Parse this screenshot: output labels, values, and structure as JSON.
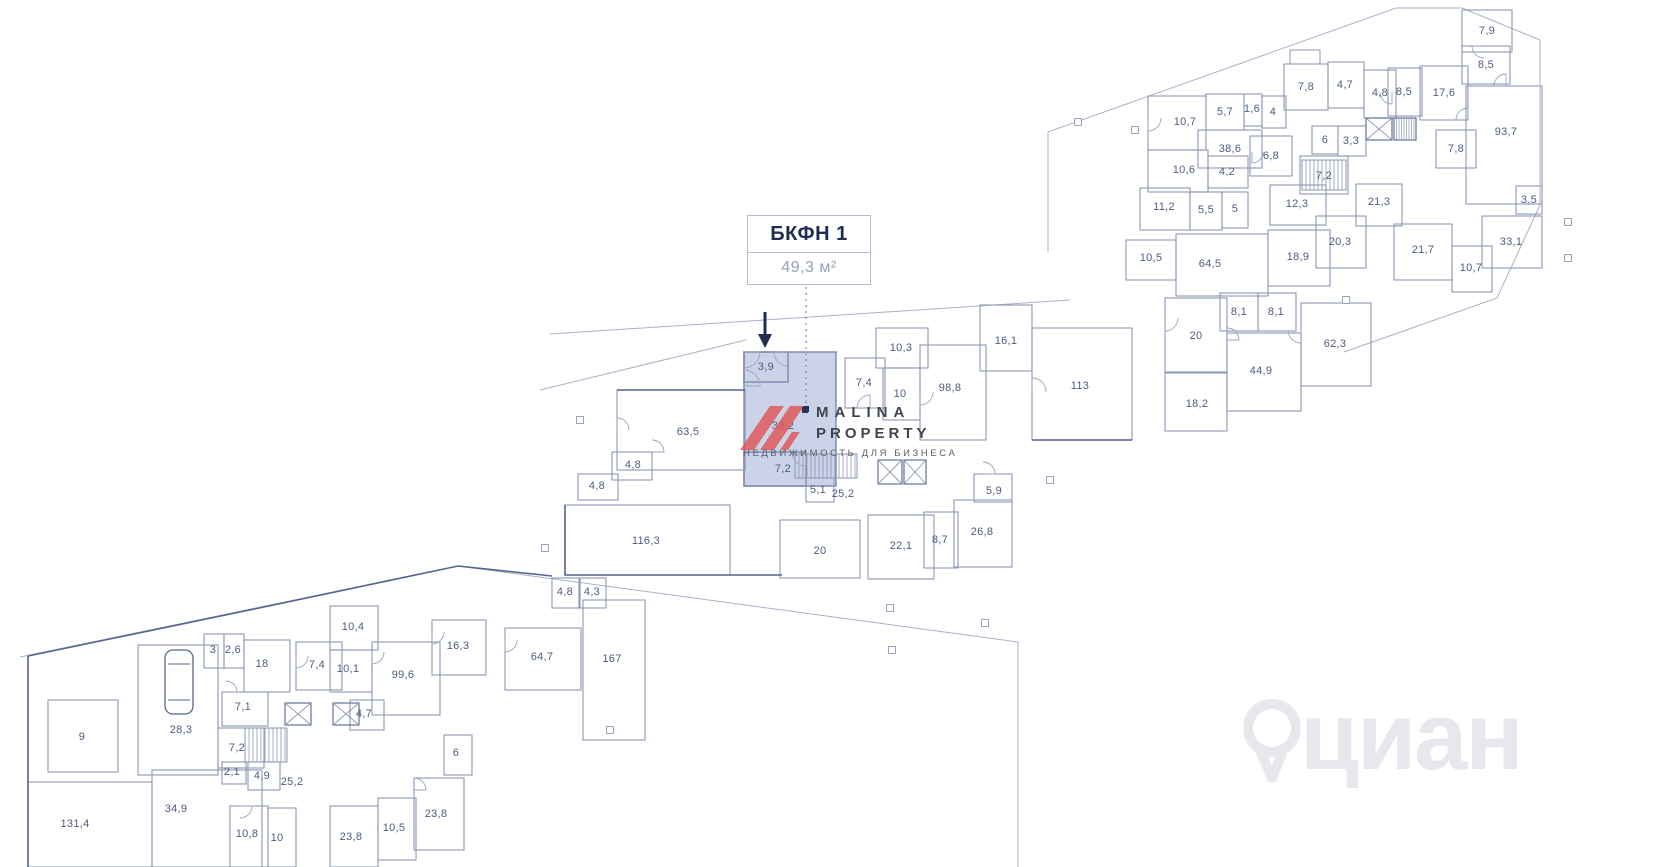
{
  "callout": {
    "title": "БКФН 1",
    "area": "49,3 м²"
  },
  "highlighted_unit": {
    "name": "БКФН 1",
    "total_area": "49,3 м²",
    "fill_color": "#cbd3e9",
    "room_areas": [
      "3,9",
      "38,2",
      "7,2"
    ]
  },
  "brand": {
    "line1": "MALINA",
    "line2": "PROPERTY",
    "tagline": "НЕДВИЖИМОСТЬ ДЛЯ БИЗНЕСА",
    "logo_color": "#e05b5b"
  },
  "cian": {
    "text": "циан"
  },
  "colors": {
    "wall": "#56648e",
    "wall_light": "#8d97b6",
    "site_line": "#a9b1c9",
    "label": "#4d5b80",
    "accent_navy": "#1f2d52",
    "highlight": "#cbd3e9",
    "logo_red": "#e05b5b"
  },
  "rooms": [
    {
      "label": "10,7",
      "x": 1185,
      "y": 122
    },
    {
      "label": "5,7",
      "x": 1225,
      "y": 112
    },
    {
      "label": "1,6",
      "x": 1252,
      "y": 109
    },
    {
      "label": "4",
      "x": 1273,
      "y": 112
    },
    {
      "label": "38,6",
      "x": 1230,
      "y": 149
    },
    {
      "label": "10,6",
      "x": 1184,
      "y": 170
    },
    {
      "label": "4,2",
      "x": 1227,
      "y": 172
    },
    {
      "label": "6,8",
      "x": 1271,
      "y": 156
    },
    {
      "label": "7,8",
      "x": 1306,
      "y": 87
    },
    {
      "label": "4,7",
      "x": 1345,
      "y": 85
    },
    {
      "label": "4,8",
      "x": 1380,
      "y": 93
    },
    {
      "label": "8,5",
      "x": 1404,
      "y": 92
    },
    {
      "label": "17,6",
      "x": 1444,
      "y": 93
    },
    {
      "label": "7,9",
      "x": 1487,
      "y": 31
    },
    {
      "label": "8,5",
      "x": 1486,
      "y": 65
    },
    {
      "label": "93,7",
      "x": 1506,
      "y": 132
    },
    {
      "label": "7,8",
      "x": 1456,
      "y": 149
    },
    {
      "label": "6",
      "x": 1325,
      "y": 140
    },
    {
      "label": "3,3",
      "x": 1351,
      "y": 141
    },
    {
      "label": "7,2",
      "x": 1324,
      "y": 176
    },
    {
      "label": "11,2",
      "x": 1164,
      "y": 207
    },
    {
      "label": "5,5",
      "x": 1206,
      "y": 210
    },
    {
      "label": "5",
      "x": 1235,
      "y": 209
    },
    {
      "label": "12,3",
      "x": 1297,
      "y": 204
    },
    {
      "label": "10,5",
      "x": 1151,
      "y": 258
    },
    {
      "label": "64,5",
      "x": 1210,
      "y": 264
    },
    {
      "label": "18,9",
      "x": 1298,
      "y": 257
    },
    {
      "label": "20,3",
      "x": 1340,
      "y": 242
    },
    {
      "label": "21,3",
      "x": 1379,
      "y": 202
    },
    {
      "label": "21,7",
      "x": 1423,
      "y": 250
    },
    {
      "label": "10,7",
      "x": 1471,
      "y": 268
    },
    {
      "label": "33,1",
      "x": 1511,
      "y": 242
    },
    {
      "label": "3,5",
      "x": 1529,
      "y": 200
    },
    {
      "label": "20",
      "x": 1196,
      "y": 336
    },
    {
      "label": "8,1",
      "x": 1239,
      "y": 312
    },
    {
      "label": "8,1",
      "x": 1276,
      "y": 312
    },
    {
      "label": "44,9",
      "x": 1261,
      "y": 371
    },
    {
      "label": "62,3",
      "x": 1335,
      "y": 344
    },
    {
      "label": "18,2",
      "x": 1197,
      "y": 404
    },
    {
      "label": "113",
      "x": 1080,
      "y": 386
    },
    {
      "label": "16,1",
      "x": 1006,
      "y": 341
    },
    {
      "label": "98,8",
      "x": 950,
      "y": 388
    },
    {
      "label": "10",
      "x": 900,
      "y": 394
    },
    {
      "label": "7,4",
      "x": 864,
      "y": 383
    },
    {
      "label": "10,3",
      "x": 901,
      "y": 348
    },
    {
      "label": "63,5",
      "x": 688,
      "y": 432
    },
    {
      "label": "3,9",
      "x": 766,
      "y": 367
    },
    {
      "label": "38,2",
      "x": 783,
      "y": 426
    },
    {
      "label": "7,2",
      "x": 783,
      "y": 469
    },
    {
      "label": "4,8",
      "x": 633,
      "y": 465
    },
    {
      "label": "4,8",
      "x": 597,
      "y": 486
    },
    {
      "label": "5,1",
      "x": 818,
      "y": 490
    },
    {
      "label": "25,2",
      "x": 843,
      "y": 494
    },
    {
      "label": "116,3",
      "x": 646,
      "y": 541
    },
    {
      "label": "20",
      "x": 820,
      "y": 551
    },
    {
      "label": "22,1",
      "x": 901,
      "y": 546
    },
    {
      "label": "8,7",
      "x": 940,
      "y": 540
    },
    {
      "label": "26,8",
      "x": 982,
      "y": 532
    },
    {
      "label": "5,9",
      "x": 994,
      "y": 491
    },
    {
      "label": "4,8",
      "x": 565,
      "y": 592
    },
    {
      "label": "4,3",
      "x": 592,
      "y": 592
    },
    {
      "label": "64,7",
      "x": 542,
      "y": 657
    },
    {
      "label": "167",
      "x": 612,
      "y": 659
    },
    {
      "label": "16,3",
      "x": 458,
      "y": 646
    },
    {
      "label": "6",
      "x": 456,
      "y": 753
    },
    {
      "label": "99,6",
      "x": 403,
      "y": 675
    },
    {
      "label": "10,4",
      "x": 353,
      "y": 627
    },
    {
      "label": "10,1",
      "x": 348,
      "y": 669
    },
    {
      "label": "7,4",
      "x": 317,
      "y": 665
    },
    {
      "label": "18",
      "x": 262,
      "y": 664
    },
    {
      "label": "3",
      "x": 213,
      "y": 650
    },
    {
      "label": "2,6",
      "x": 233,
      "y": 650
    },
    {
      "label": "7,1",
      "x": 243,
      "y": 707
    },
    {
      "label": "7,2",
      "x": 237,
      "y": 748
    },
    {
      "label": "4,7",
      "x": 364,
      "y": 714
    },
    {
      "label": "2,1",
      "x": 232,
      "y": 772
    },
    {
      "label": "4,9",
      "x": 262,
      "y": 776
    },
    {
      "label": "25,2",
      "x": 292,
      "y": 782
    },
    {
      "label": "9",
      "x": 82,
      "y": 737
    },
    {
      "label": "28,3",
      "x": 181,
      "y": 730
    },
    {
      "label": "131,4",
      "x": 75,
      "y": 824
    },
    {
      "label": "34,9",
      "x": 176,
      "y": 809
    },
    {
      "label": "10,8",
      "x": 247,
      "y": 834
    },
    {
      "label": "10",
      "x": 277,
      "y": 838
    },
    {
      "label": "23,8",
      "x": 351,
      "y": 837
    },
    {
      "label": "10,5",
      "x": 394,
      "y": 828
    },
    {
      "label": "23,8",
      "x": 436,
      "y": 814
    }
  ]
}
